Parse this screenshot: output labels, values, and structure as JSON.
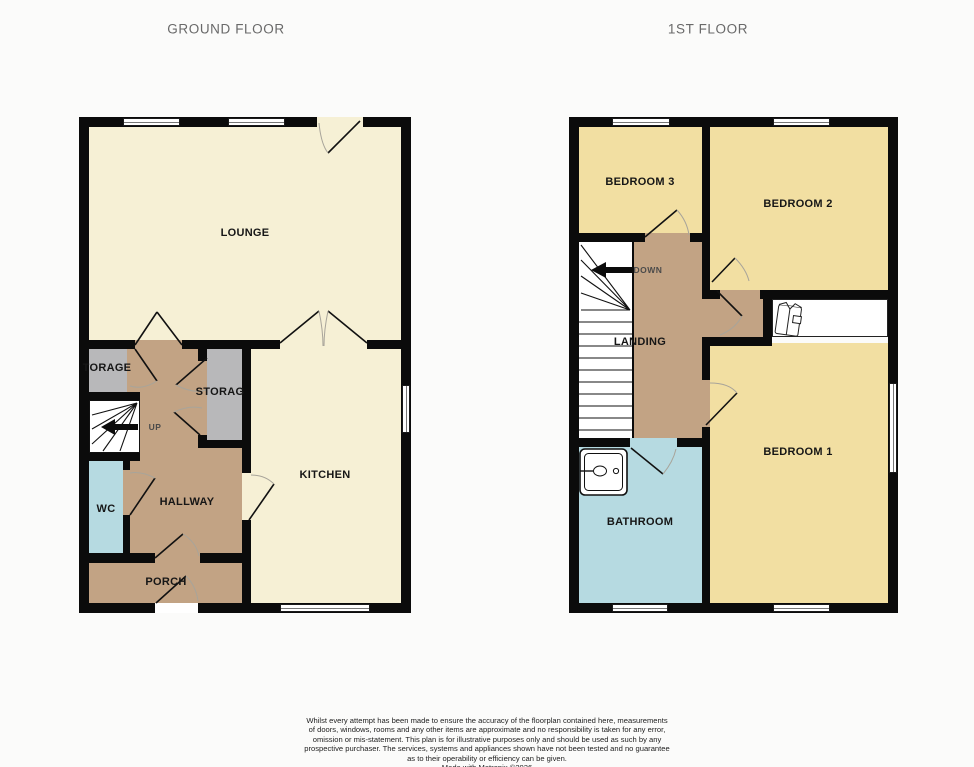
{
  "colors": {
    "wall": "#0b0b0b",
    "cream": "#f6f0d5",
    "yellow": "#f2dfa2",
    "tan": "#c2a384",
    "grey": "#b8b8ba",
    "blue": "#b6dae1",
    "page-bg": "#fbfbfa",
    "title-text": "#696969",
    "label-text": "#161616"
  },
  "titles": {
    "ground_floor": "GROUND FLOOR",
    "first_floor": "1ST FLOOR"
  },
  "ground_floor": {
    "lounge": "LOUNGE",
    "kitchen": "KITCHEN",
    "hallway": "HALLWAY",
    "porch": "PORCH",
    "wc": "WC",
    "storage_left": "TORAGE",
    "storage_right": "STORAG",
    "stairs_direction": "UP"
  },
  "first_floor": {
    "bedroom1": "BEDROOM 1",
    "bedroom2": "BEDROOM 2",
    "bedroom3": "BEDROOM 3",
    "landing": "LANDING",
    "bathroom": "BATHROOM",
    "stairs_direction": "DOWN"
  },
  "disclaimer": {
    "lines": [
      "Whilst every attempt has been made to ensure the accuracy of the floorplan contained here, measurements",
      "of doors, windows, rooms and any other items are approximate and no responsibility is taken for any error,",
      "omission or mis-statement. This plan is for illustrative purposes only and should be used as such by any",
      "prospective purchaser. The services, systems and appliances shown have not been tested and no guarantee",
      "as to their operability or efficiency can be given."
    ],
    "credit": "Made with Metropix ©2026"
  }
}
